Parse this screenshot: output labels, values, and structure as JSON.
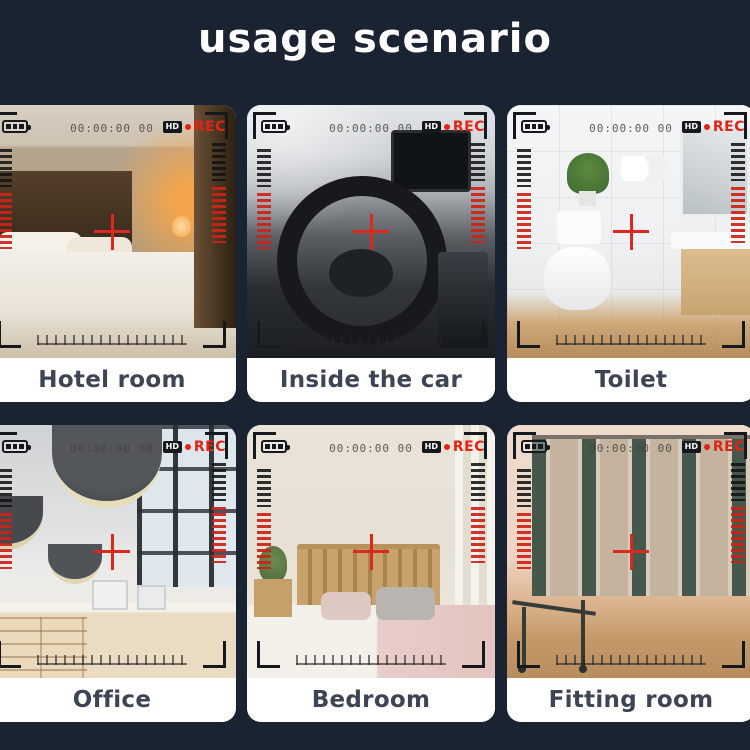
{
  "title": "usage scenario",
  "overlay": {
    "timecode": "00:00:00 00",
    "hd": "HD",
    "rec": "REC"
  },
  "tiles": [
    {
      "label": "Hotel room"
    },
    {
      "label": "Inside the car"
    },
    {
      "label": "Toilet"
    },
    {
      "label": "Office"
    },
    {
      "label": "Bedroom"
    },
    {
      "label": "Fitting room"
    }
  ],
  "colors": {
    "background": "#1a2332",
    "card_background": "#ffffff",
    "label_text": "#3d4455",
    "title_text": "#ffffff",
    "rec_red": "#e42315",
    "crosshair_red": "#da2a1e"
  }
}
